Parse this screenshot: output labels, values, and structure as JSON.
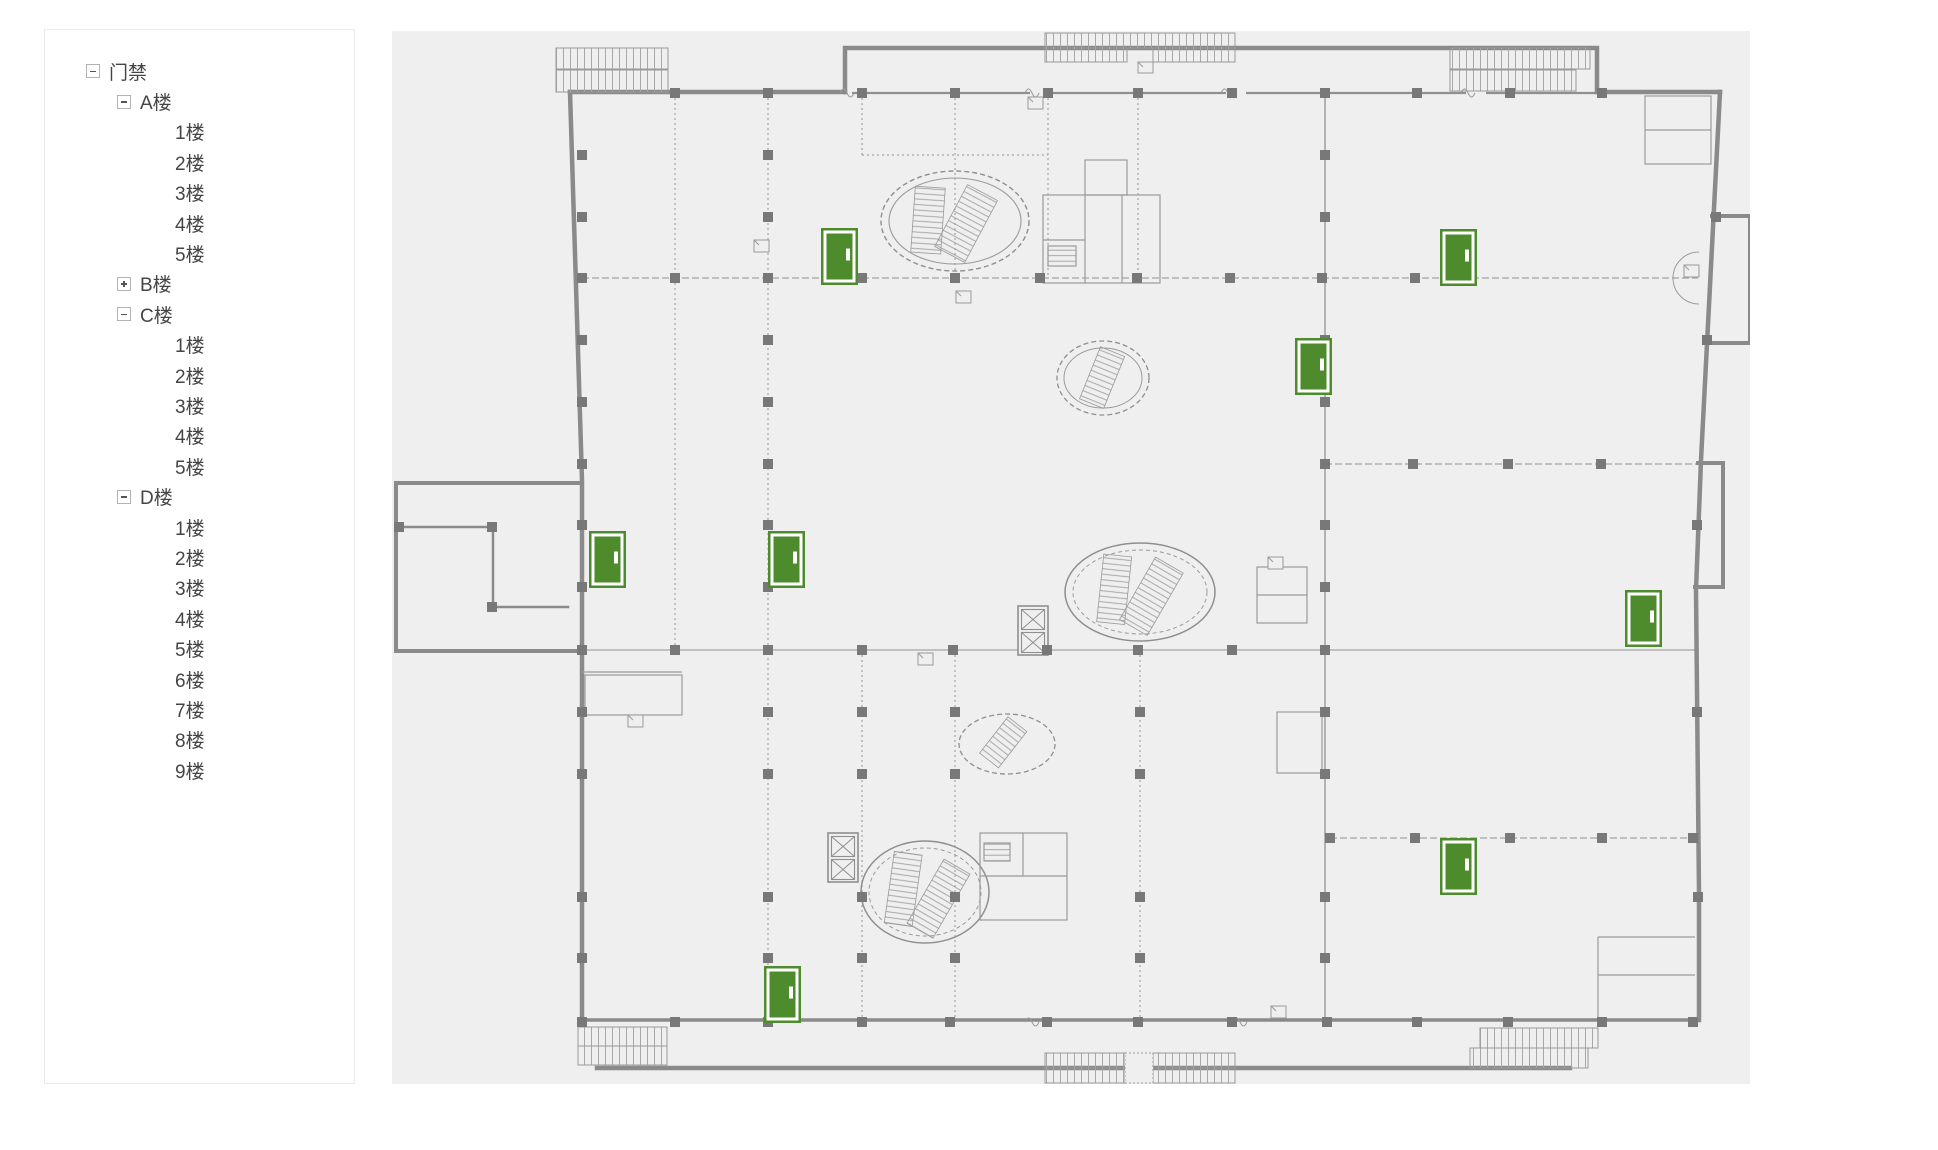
{
  "sidebar": {
    "tree": [
      {
        "id": "access-control",
        "label": "门禁",
        "level": 0,
        "expander": "minus"
      },
      {
        "id": "building-a",
        "label": "A楼",
        "level": 1,
        "expander": "minus"
      },
      {
        "id": "building-a-floor-1",
        "label": "1楼",
        "level": 2,
        "expander": "none"
      },
      {
        "id": "building-a-floor-2",
        "label": "2楼",
        "level": 2,
        "expander": "none"
      },
      {
        "id": "building-a-floor-3",
        "label": "3楼",
        "level": 2,
        "expander": "none"
      },
      {
        "id": "building-a-floor-4",
        "label": "4楼",
        "level": 2,
        "expander": "none"
      },
      {
        "id": "building-a-floor-5",
        "label": "5楼",
        "level": 2,
        "expander": "none"
      },
      {
        "id": "building-b",
        "label": "B楼",
        "level": 1,
        "expander": "plus"
      },
      {
        "id": "building-c",
        "label": "C楼",
        "level": 1,
        "expander": "minus"
      },
      {
        "id": "building-c-floor-1",
        "label": "1楼",
        "level": 2,
        "expander": "none"
      },
      {
        "id": "building-c-floor-2",
        "label": "2楼",
        "level": 2,
        "expander": "none"
      },
      {
        "id": "building-c-floor-3",
        "label": "3楼",
        "level": 2,
        "expander": "none"
      },
      {
        "id": "building-c-floor-4",
        "label": "4楼",
        "level": 2,
        "expander": "none"
      },
      {
        "id": "building-c-floor-5",
        "label": "5楼",
        "level": 2,
        "expander": "none"
      },
      {
        "id": "building-d",
        "label": "D楼",
        "level": 1,
        "expander": "minus"
      },
      {
        "id": "building-d-floor-1",
        "label": "1楼",
        "level": 2,
        "expander": "none"
      },
      {
        "id": "building-d-floor-2",
        "label": "2楼",
        "level": 2,
        "expander": "none"
      },
      {
        "id": "building-d-floor-3",
        "label": "3楼",
        "level": 2,
        "expander": "none"
      },
      {
        "id": "building-d-floor-4",
        "label": "4楼",
        "level": 2,
        "expander": "none"
      },
      {
        "id": "building-d-floor-5",
        "label": "5楼",
        "level": 2,
        "expander": "none"
      },
      {
        "id": "building-d-floor-6",
        "label": "6楼",
        "level": 2,
        "expander": "none"
      },
      {
        "id": "building-d-floor-7",
        "label": "7楼",
        "level": 2,
        "expander": "none"
      },
      {
        "id": "building-d-floor-8",
        "label": "8楼",
        "level": 2,
        "expander": "none"
      },
      {
        "id": "building-d-floor-9",
        "label": "9楼",
        "level": 2,
        "expander": "none"
      }
    ]
  },
  "floorplan": {
    "background": "#efefef",
    "wall_color": "#8a8a8a",
    "line_color": "#a4a4a4",
    "column_color": "#787878",
    "door_color": "#4e8b2d",
    "door_frame_color": "#ffffff",
    "door_size": {
      "w": 37,
      "h": 57
    },
    "doors": [
      {
        "id": "door-1",
        "x": 821,
        "y": 228
      },
      {
        "id": "door-2",
        "x": 1440,
        "y": 229
      },
      {
        "id": "door-3",
        "x": 1295,
        "y": 338
      },
      {
        "id": "door-4",
        "x": 589,
        "y": 531
      },
      {
        "id": "door-5",
        "x": 768,
        "y": 531
      },
      {
        "id": "door-6",
        "x": 1625,
        "y": 590
      },
      {
        "id": "door-7",
        "x": 1440,
        "y": 838
      },
      {
        "id": "door-8",
        "x": 764,
        "y": 966
      }
    ]
  }
}
